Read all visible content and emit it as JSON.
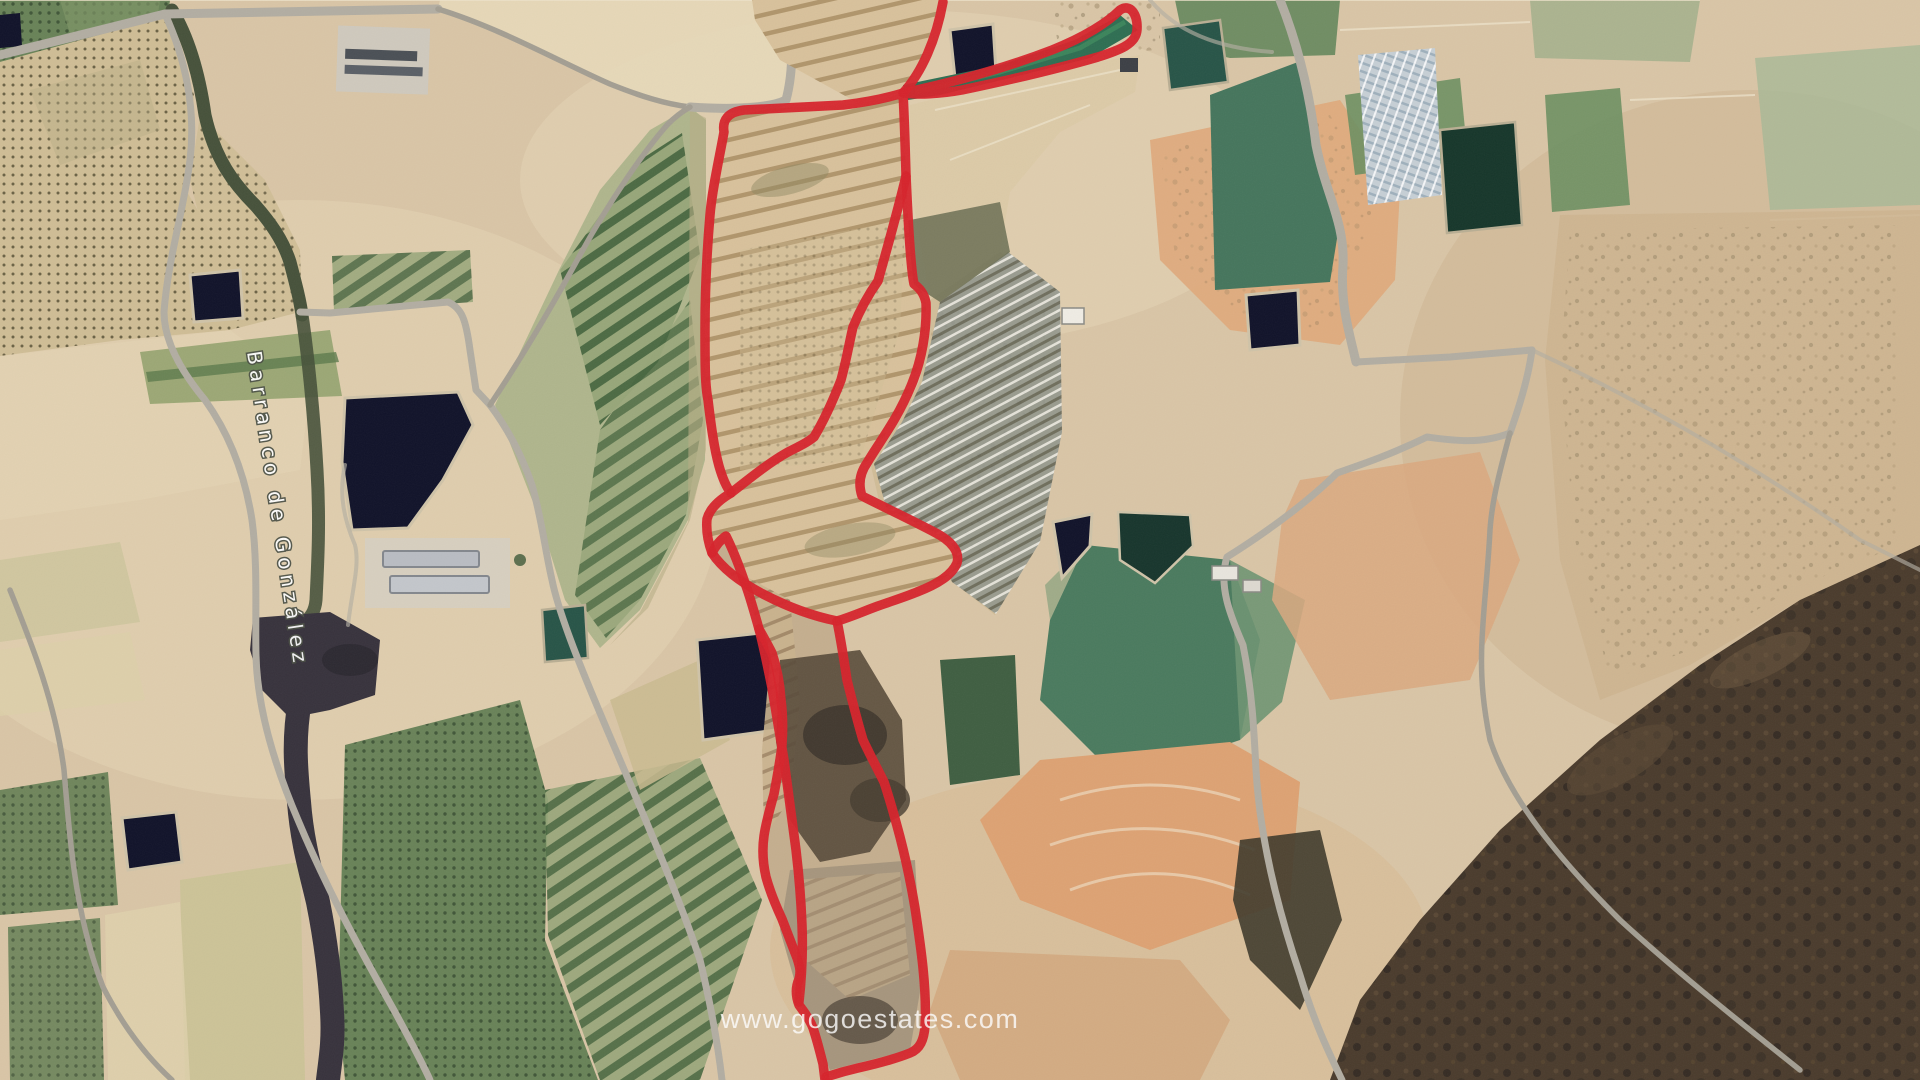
{
  "meta": {
    "description": "Aerial satellite view of rural farmland with red property boundary overlay",
    "view_type": "satellite-aerial"
  },
  "watermark": {
    "text": "www.gogoestates.com"
  },
  "labels": {
    "stream_road": "Barranco de González"
  },
  "boundary": {
    "style": "red-outline",
    "parcels": 3
  },
  "colors": {
    "boundary": "#d6232b",
    "road": "#b2ada2",
    "road_minor": "#a39e92",
    "pond": "#101229",
    "pond_green": "#275447",
    "stream": "#46513a",
    "stream_dark": "#37323c",
    "base_tan": "#d9c5a6",
    "sand": "#e8dabb",
    "salmon": "#dda67a",
    "field_green": "#57784e",
    "field_teal": "#2f6e52",
    "hills_dark": "#443729",
    "greenhouse": "#93998f",
    "solar": "#c6cfd5",
    "watermark_color": "#ffffff"
  }
}
